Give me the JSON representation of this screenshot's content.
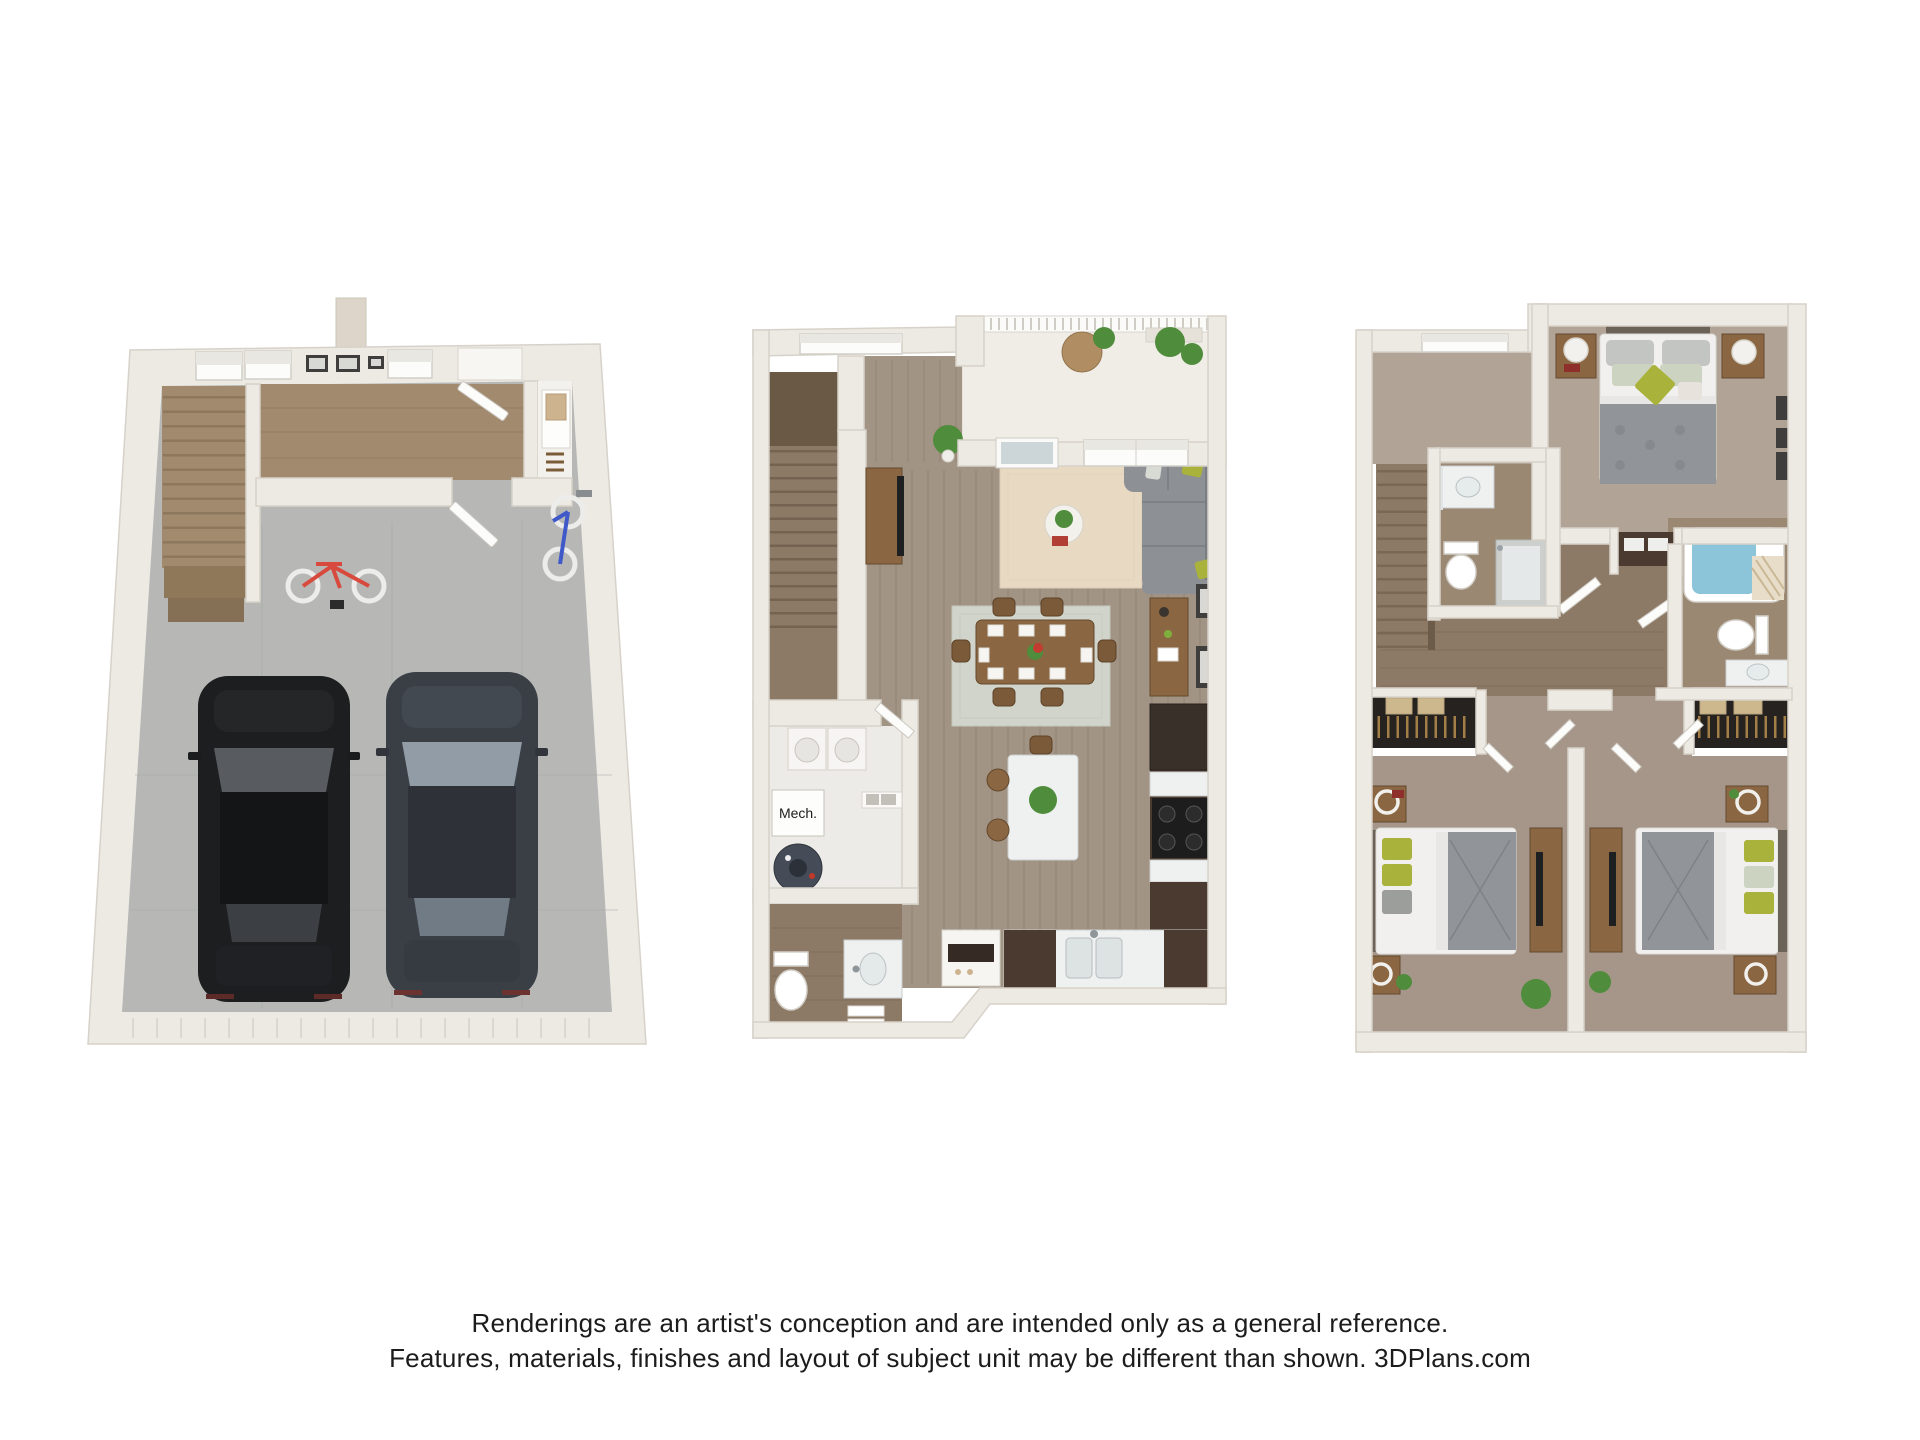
{
  "footer": {
    "line1": "Renderings are an artist's conception and are intended only as a general reference.",
    "line2": "Features, materials, finishes and layout of subject unit may be different than shown. 3DPlans.com"
  },
  "labels": {
    "mech_room": "Mech."
  },
  "colors": {
    "text": "#1c1c1c",
    "wall": "#edeae4",
    "wallline": "#d7d2c9",
    "wallface": "#ddd5c9",
    "concrete": "#b7b8b6",
    "woodentry": "#a18a6e",
    "woodhall": "#8d7a66",
    "woodmain": "#a29484",
    "carpet": "#b1a497",
    "carpetb": "#a59689",
    "rugliving": "#e8d9c3",
    "rugdining": "#d0d4ca",
    "sofa": "#8d9094",
    "sofadark": "#7a7d82",
    "furnwood": "#8a6742",
    "furnwooddark": "#64492d",
    "cabinet": "#4a3a2f",
    "marble": "#eff1f0",
    "bedwhite": "#f1f0ee",
    "bedgray": "#91959a",
    "green": "#a9b23a",
    "plant": "#4f8c3b",
    "water": "#8cc4d9",
    "frame": "#3f3e3c",
    "car1": "#1d1e20",
    "car1glass": "#585c60",
    "car2": "#3a3f46",
    "car2glass": "#929ca7",
    "bikered": "#d84a3e",
    "bikeblue": "#3f5ac8",
    "headboard": "#6b6258",
    "lamp": "#f2f1ed"
  }
}
